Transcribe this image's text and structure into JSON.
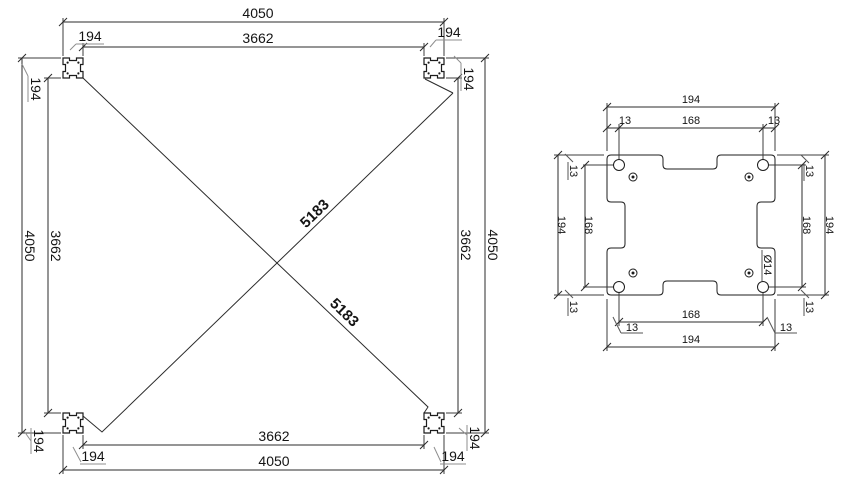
{
  "page": {
    "background": "#ffffff",
    "line_color": "#2b2b2b",
    "leader_color": "#8f8f8f",
    "text_color": "#141414"
  },
  "frame_plan": {
    "labels": {
      "overall": "4050",
      "inner": "3662",
      "corner_offset": "194",
      "diagonal": "5183"
    }
  },
  "corner_plate": {
    "labels": {
      "overall": "194",
      "hole_spacing": "168",
      "edge_offset": "13",
      "hole_diameter": "Ø14"
    }
  }
}
